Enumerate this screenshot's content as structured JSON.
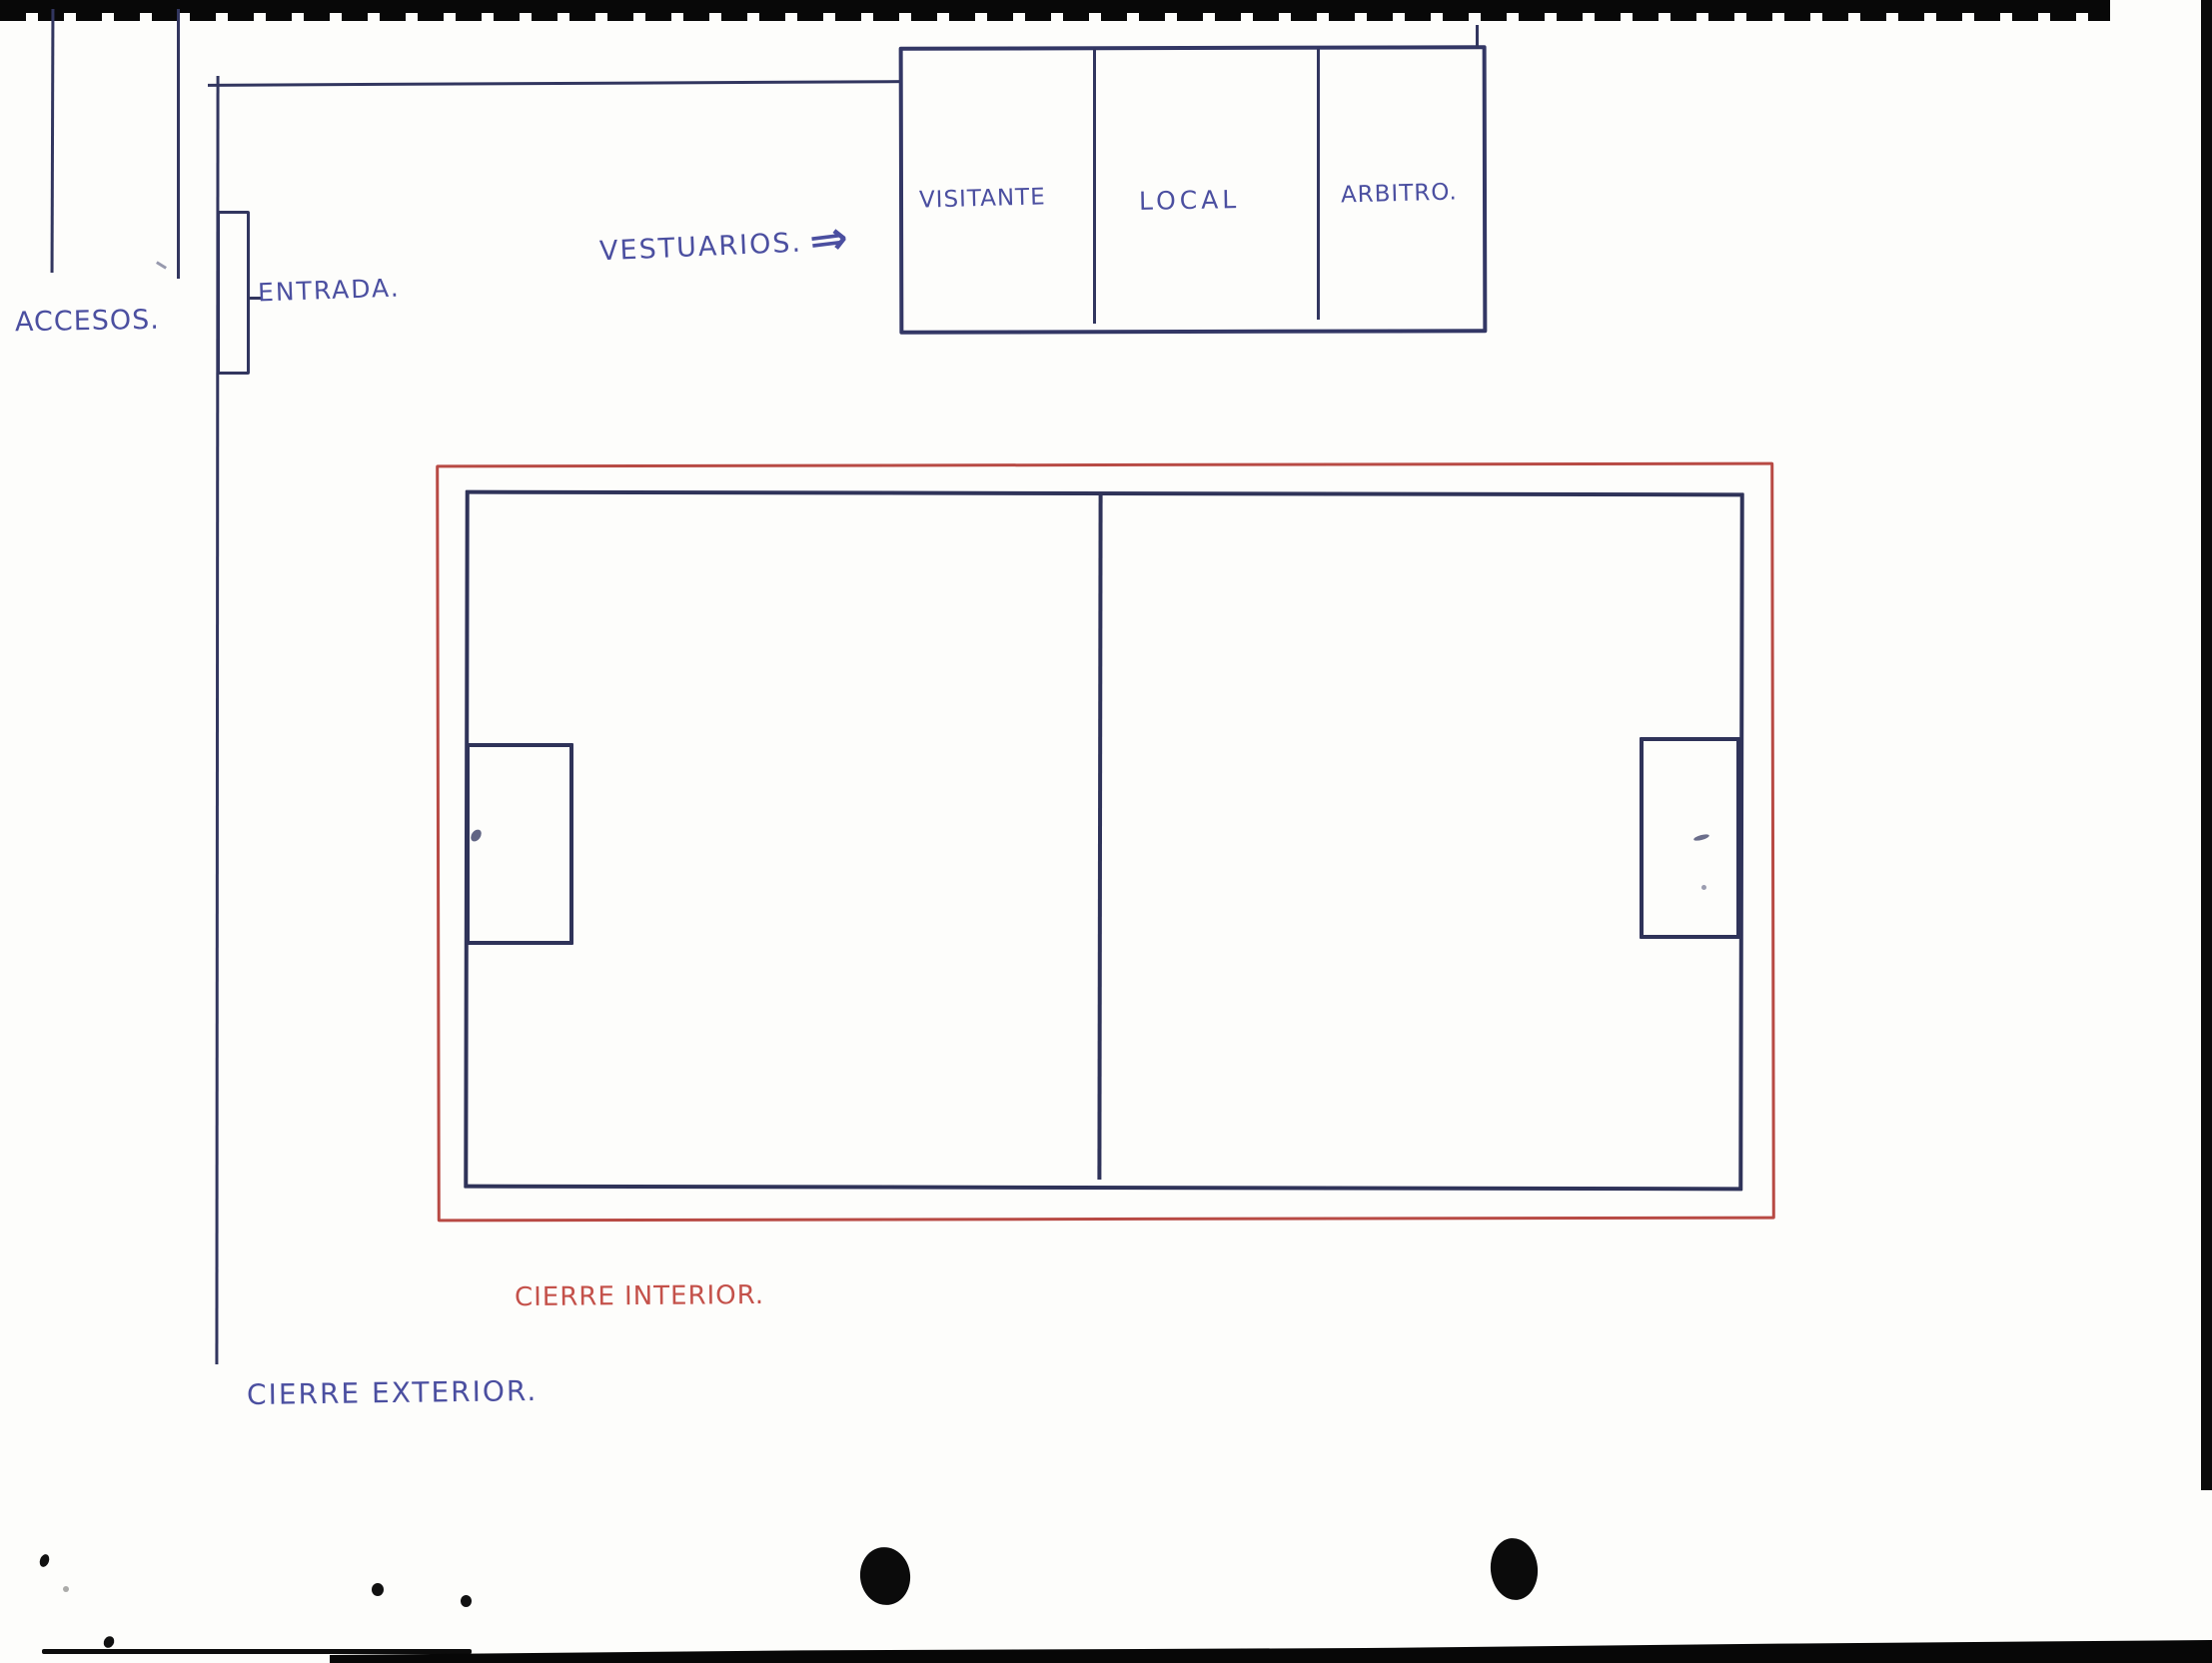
{
  "title": "Croquis de instalación deportiva",
  "labels": {
    "accesos": "ACCESOS.",
    "entrada": "ENTRADA.",
    "vestuarios": "VESTUARIOS.",
    "vestuarios_arrow": "⇒",
    "visitante": "VISITANTE",
    "local": "LOCAL",
    "arbitro": "ARBITRO.",
    "cierre_interior": "CIERRE INTERIOR.",
    "cierre_exterior": "CIERRE EXTERIOR."
  },
  "colors": {
    "ink_blue": "#4b4fa0",
    "line_navy": "#32365f",
    "pitch_navy": "#2f3359",
    "fence_red": "#b84a44",
    "text_red": "#c4514a",
    "scan_black": "#0a0a0a",
    "paper": "#fdfdfb"
  }
}
